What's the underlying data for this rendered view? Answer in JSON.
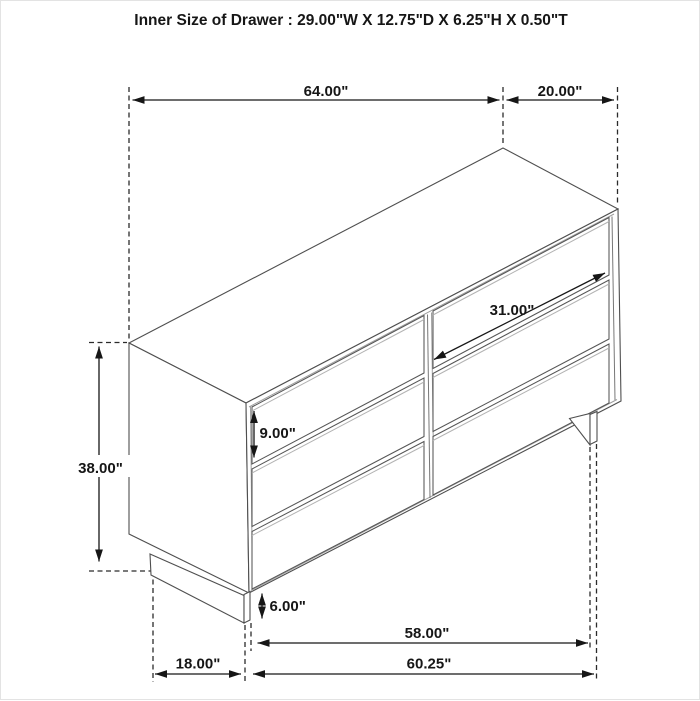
{
  "title": "Inner Size of Drawer : 29.00\"W X 12.75\"D X 6.25\"H X 0.50\"T",
  "product": {
    "type": "dresser",
    "drawer_count": 6
  },
  "dimensions": {
    "overall_width": "64.00\"",
    "overall_depth": "20.00\"",
    "overall_height": "38.00\"",
    "drawer_front_width": "31.00\"",
    "drawer_front_height": "9.00\"",
    "base_height": "6.00\"",
    "base_front_width": "58.00\"",
    "bottom_width": "60.25\"",
    "base_depth": "18.00\""
  },
  "colors": {
    "background": "#ffffff",
    "cabinet_line": "#4f4f4f",
    "dimension_line": "#161616",
    "shadow_line": "#b3b3b3",
    "text": "#161616"
  }
}
